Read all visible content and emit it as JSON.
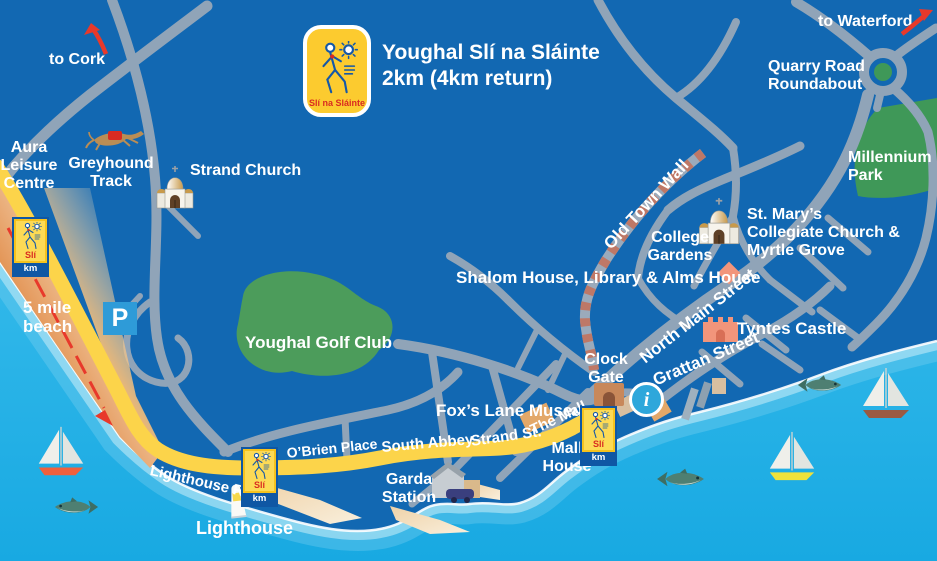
{
  "header": {
    "title": "Youghal Slí na Sláinte",
    "subtitle": "2km (4km return)",
    "logo_brand": "Slí na Sláinte"
  },
  "directions": {
    "cork": "to Cork",
    "waterford": "to Waterford"
  },
  "places": {
    "quarry_road": "Quarry Road",
    "roundabout": "Roundabout",
    "millennium": "Millennium",
    "park": "Park",
    "aura1": "Aura",
    "aura2": "Leisure",
    "aura3": "Centre",
    "greyhound1": "Greyhound",
    "greyhound2": "Track",
    "strand_church": "Strand Church",
    "old_town_wall": "Old Town Wall",
    "college1": "College",
    "college2": "Gardens",
    "st_marys1": "St. Mary’s",
    "st_marys2": "Collegiate Church &",
    "st_marys3": "Myrtle Grove",
    "shalom": "Shalom House, Library & Alms House",
    "tyntes": "Tyntes Castle",
    "north_main": "North Main Street",
    "grattan": "Grattan Street",
    "clock1": "Clock",
    "clock2": "Gate",
    "foxs": "Fox’s Lane Museum",
    "golf": "Youghal Golf Club",
    "beach1": "5 mile",
    "beach2": "beach",
    "obrien": "O’Brien Place",
    "south_abbey": "South Abbey",
    "strand_st": "Strand St.",
    "the_mall": "The Mall",
    "garda1": "Garda",
    "garda2": "Station",
    "mall_house1": "Mall",
    "mall_house2": "House",
    "lighthouse_rd": "Lighthouse Rd",
    "lighthouse": "Lighthouse"
  },
  "markers": {
    "parking": "P",
    "info": "i",
    "sli": "Slí",
    "km": "km"
  },
  "icons": {
    "walking_man": "walking-man-icon",
    "sun": "sun-icon",
    "church": "church-icon",
    "castle": "castle-icon",
    "greyhound": "greyhound-icon",
    "lighthouse": "lighthouse-icon",
    "sailboat": "sailboat-icon",
    "fish": "fish-icon",
    "parking": "parking-icon",
    "info": "info-icon",
    "arrow": "direction-arrow-icon",
    "clock_gate": "clock-gate-icon"
  },
  "colors": {
    "land": "#1268B2",
    "sea": "#25B2E7",
    "road": "#90A4B8",
    "route_yellow": "#FCD44A",
    "beach_dark": "#E08945",
    "beach_light": "#FBEED7",
    "green": "#4C9C5B",
    "wall_dash": "#BE7867",
    "sign_yellow": "#FCCB2F",
    "sign_blue": "#0F57A4",
    "accent_red": "#E8392B",
    "info_blue": "#2EA7DB",
    "building_salmon": "#F2957B",
    "building_tan": "#D1955C"
  }
}
